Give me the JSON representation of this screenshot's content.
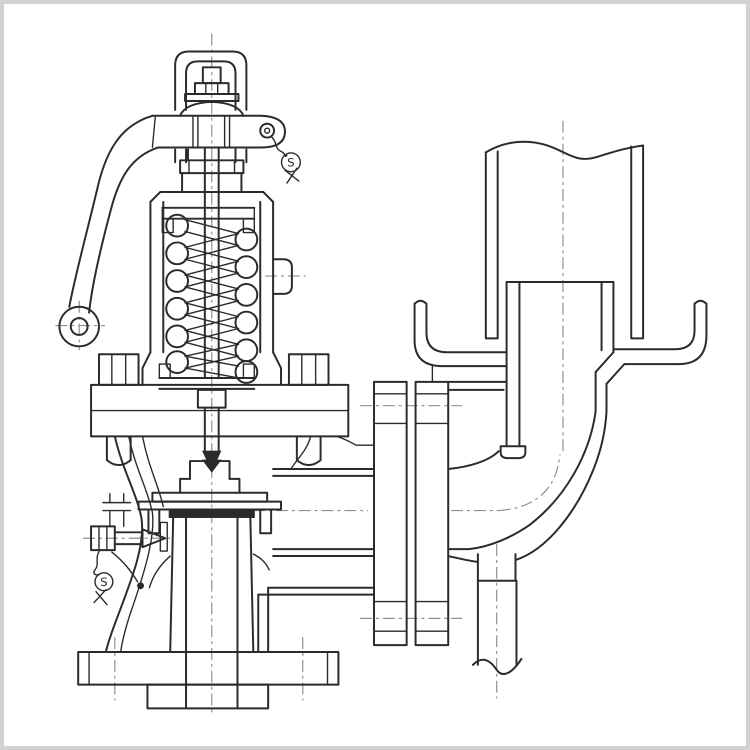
{
  "page": {
    "background": "#ffffff",
    "frame_color": "#d2d2d2"
  },
  "drawing": {
    "type": "technical-sectional-drawing",
    "subject": "Lever-type spring-loaded safety relief valve in cross-section, bolted to a discharge elbow with drip pan, slip-jointed vent pipe and bottom drain",
    "line_color": "#2b2b2b",
    "centerline_color": "#8f8f8f",
    "seals": [
      {
        "label": "S",
        "location": "lever-pivot-wire-seal"
      },
      {
        "label": "S",
        "location": "test-gag-wire-seal"
      }
    ]
  }
}
